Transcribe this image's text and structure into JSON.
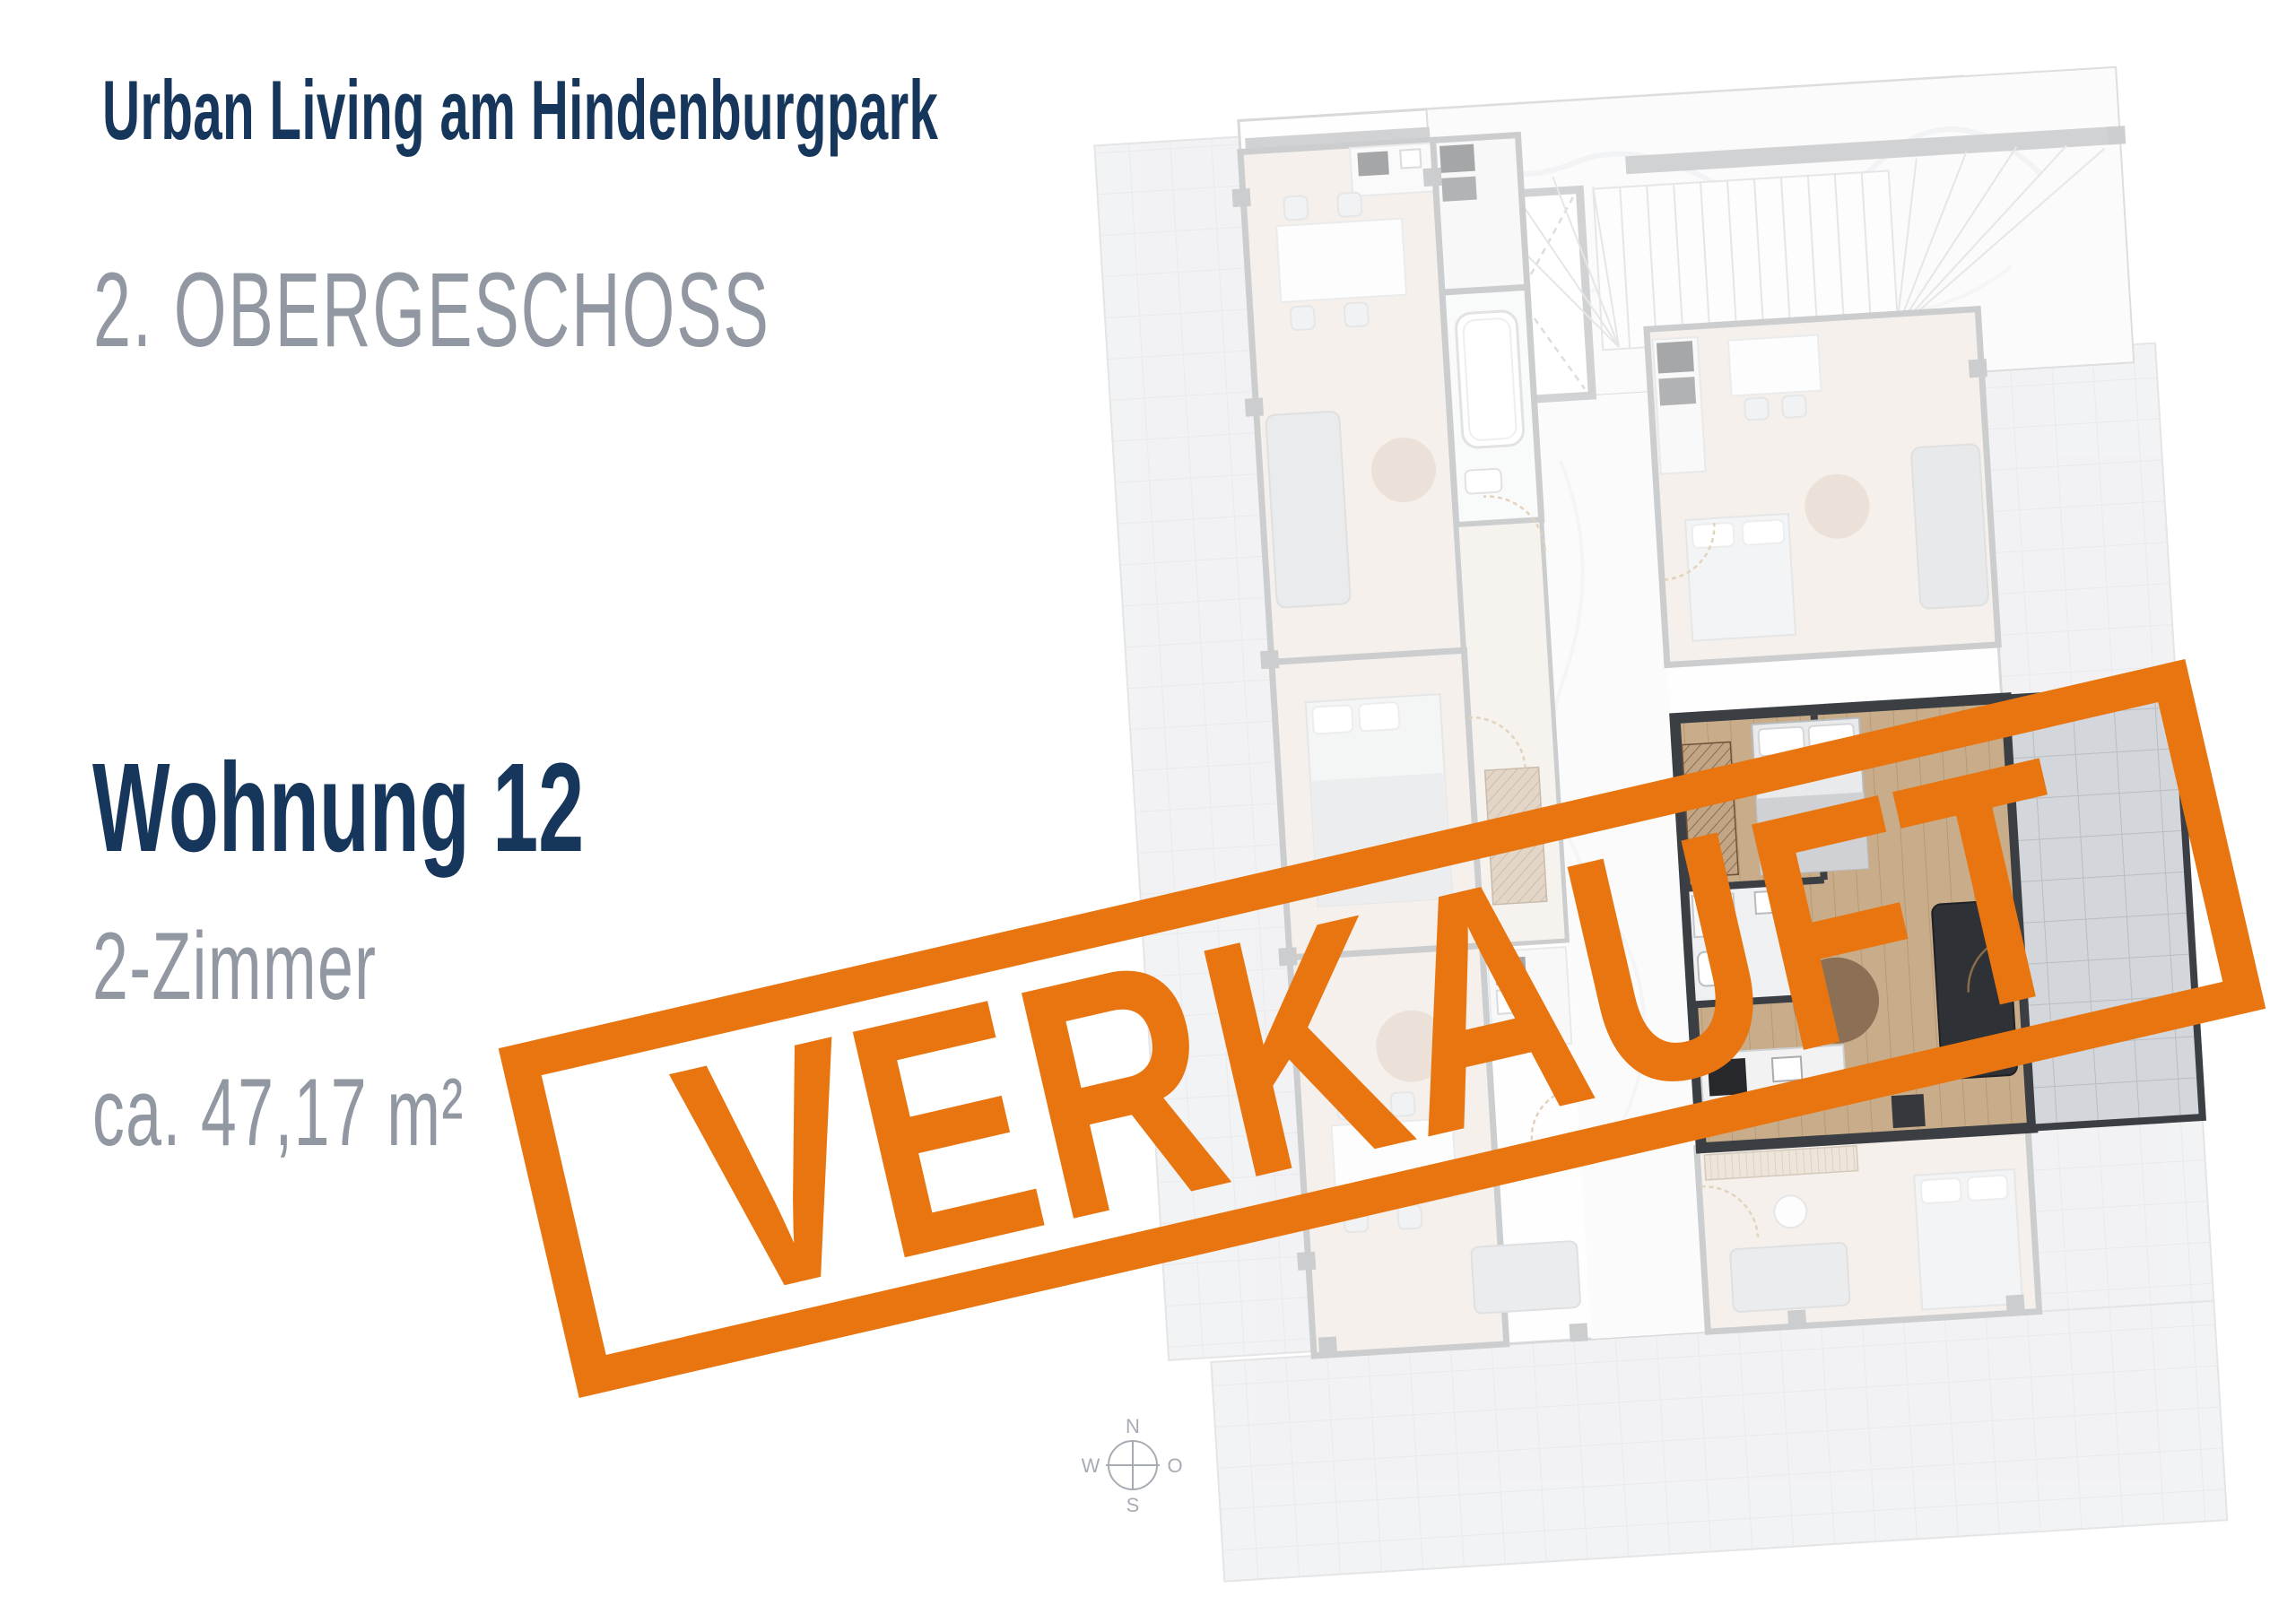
{
  "page": {
    "project_title": "Urban Living am Hindenburgpark",
    "floor_title": "2. OBERGESCHOSS",
    "unit": {
      "name": "Wohnung 12",
      "rooms": "2-Zimmer",
      "area": "ca. 47,17 m²"
    },
    "stamp": {
      "label": "VERKAUFT"
    },
    "compass": {
      "north": "N",
      "east": "O",
      "south": "S",
      "west": "W"
    },
    "colors": {
      "navy": "#16365C",
      "text_gray": "#9298A2",
      "orange": "#E8750F"
    }
  }
}
